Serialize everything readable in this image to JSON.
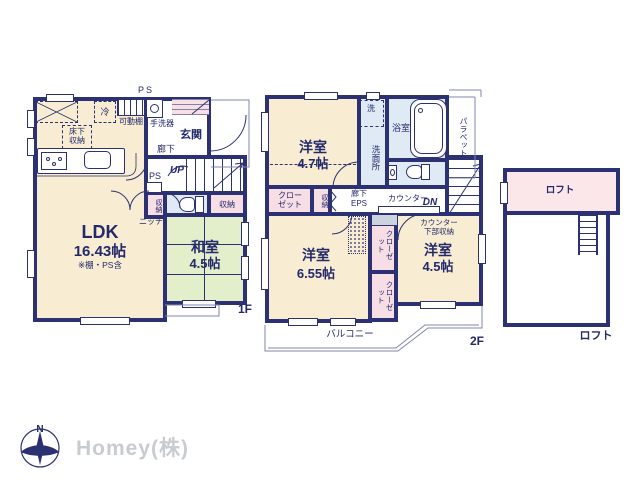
{
  "meta": {
    "type": "floor-plan",
    "company_logo": "Homey(株)",
    "compass_north": "N"
  },
  "colors": {
    "wall": "#2b3173",
    "room_cream": "#f8edd2",
    "tatami_green": "#e3eecb",
    "storage_pink": "#f7dde4",
    "loft_pink": "#fbe6ea",
    "wet_blue": "#dfeaf4",
    "text_navy": "#23296b",
    "thin_line": "#8087ad",
    "logo_gray": "#c8ccd2"
  },
  "floor1": {
    "floor_label": "1F",
    "ps_top": "PS",
    "ps_mid": "PS",
    "fridge": "冷",
    "movable_shelf": "可動棚",
    "hand_basin": "手洗器",
    "entrance": "玄関",
    "corridor": "廊下",
    "underfloor_storage": "床下収納",
    "up": "UP",
    "storage_narrow": "収納",
    "storage_pink": "収納",
    "niche": "ニッチ",
    "ldk": "LDK",
    "ldk_size": "16.43帖",
    "ldk_note": "※棚・PS含",
    "washitsu": "和室",
    "washitsu_size": "4.5帖"
  },
  "floor2": {
    "floor_label": "2F",
    "bedroom1": "洋室",
    "bedroom1_size": "4.7帖",
    "washer": "洗",
    "washroom": "洗面所",
    "bathroom": "浴室",
    "parapet": "パラペット",
    "closet_a": "クローゼット",
    "storage_narrow": "収納",
    "corridor": "廊下",
    "eps": "EPS",
    "counter": "カウンター",
    "dn": "DN",
    "counter_under_storage": "カウンター下部収納",
    "bedroom2": "洋室",
    "bedroom2_size": "6.55帖",
    "closet_b": "クローゼット",
    "closet_c": "クローゼット",
    "bedroom3": "洋室",
    "bedroom3_size": "4.5帖",
    "balcony": "バルコニー"
  },
  "loft": {
    "label_inside": "ロフト",
    "label_outside": "ロフト"
  }
}
